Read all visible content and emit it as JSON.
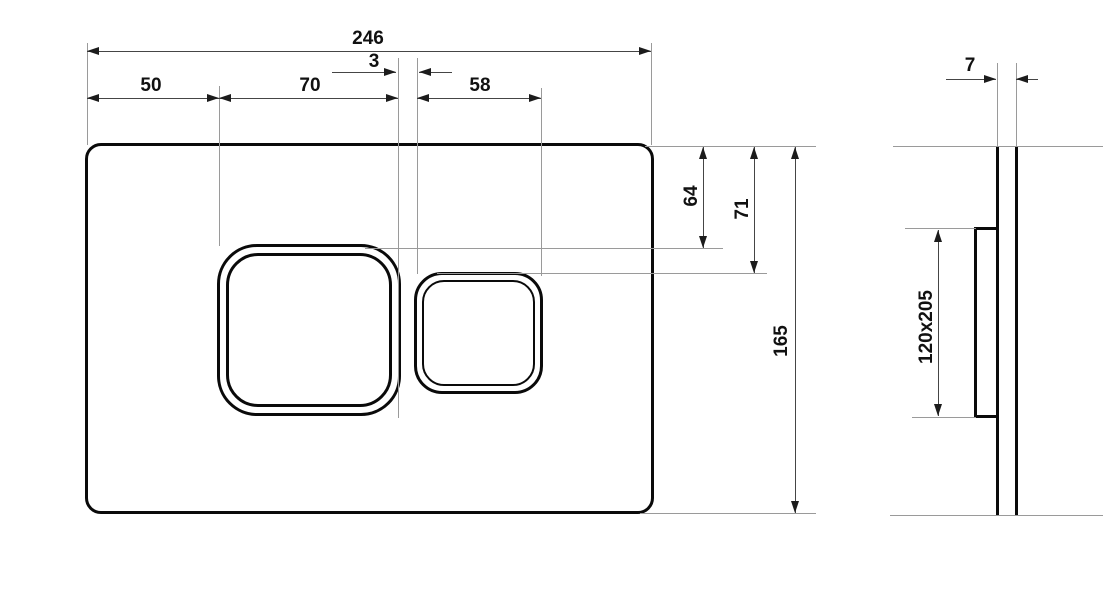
{
  "labels": {
    "d246": "246",
    "d3": "3",
    "d50": "50",
    "d70": "70",
    "d58": "58",
    "d64": "64",
    "d71": "71",
    "d165": "165",
    "d7": "7",
    "d120x205": "120x205"
  },
  "colors": {
    "background": "#ffffff",
    "outline": "#0a0a0a",
    "dimension_line": "#454545",
    "extension_line": "#9a9a9a",
    "arrowhead": "#1c1c1c",
    "text": "#111111"
  }
}
